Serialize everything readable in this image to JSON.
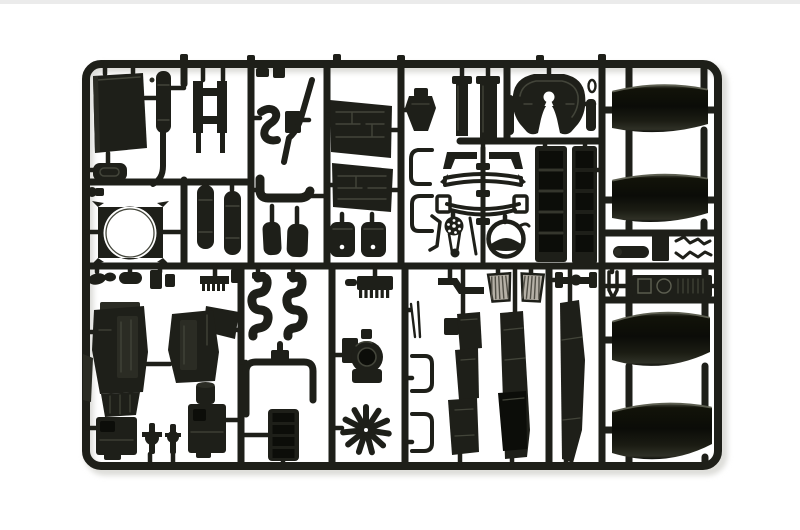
{
  "image": {
    "kind": "photograph",
    "description": "Black injection-molded plastic model kit sprue (parts tree) with truck components — fenders, engine halves, fifth-wheel coupling, fan shroud, tanks, pipes and panels — photographed on a white background",
    "background": "#ffffff"
  },
  "palette": {
    "bg": "#ffffff",
    "photo_edge": "#ebebeb",
    "shadow": "#dcdcd8",
    "plastic": "#1e1f19",
    "plastic_deep": "#0c0d09",
    "plastic_mid": "#2b2c24",
    "plastic_hi": "#43453a",
    "sheen": "#5d5f51",
    "grille_fill": "#b5b0a6",
    "grille_line": "#504e45"
  },
  "parts": [
    {
      "id": "sprue-frame",
      "label": "outer sprue frame and runners"
    },
    {
      "id": "cab-roof-panel",
      "label": "large flat cab panel"
    },
    {
      "id": "exhaust-muffler-stack",
      "label": "muffler with exhaust stack pipe"
    },
    {
      "id": "cab-step-plate",
      "label": "oval step plate"
    },
    {
      "id": "hose-clamp-small",
      "label": "small clamp"
    },
    {
      "id": "radiator-fan-shroud",
      "label": "fan shroud with round opening"
    },
    {
      "id": "chassis-cross-member",
      "label": "chassis cross member"
    },
    {
      "id": "air-tanks",
      "label": "pair of cylindrical air tanks"
    },
    {
      "id": "s-shaped-hose",
      "label": "S-shaped intake hose"
    },
    {
      "id": "junction-box",
      "label": "small junction box"
    },
    {
      "id": "exhaust-down-pipe",
      "label": "diagonal exhaust pipe"
    },
    {
      "id": "elbow-pipe",
      "label": "elbow pipe"
    },
    {
      "id": "seat-pads",
      "label": "pair of seat cushions"
    },
    {
      "id": "small-fittings-top",
      "label": "small fittings"
    },
    {
      "id": "floor-panel-upper",
      "label": "textured cab floor panel"
    },
    {
      "id": "floor-panel-lower",
      "label": "textured cab floor panel"
    },
    {
      "id": "fuel-canisters",
      "label": "pair of canisters"
    },
    {
      "id": "gear-lever-boot",
      "label": "gear lever boot"
    },
    {
      "id": "pillar-trims",
      "label": "pair of pillar trim strips"
    },
    {
      "id": "suspension-assembly",
      "label": "symmetric leaf-spring suspension cluster"
    },
    {
      "id": "spring-shackle-brackets",
      "label": "wire shackle brackets"
    },
    {
      "id": "drive-pulley-belt",
      "label": "pulley with drive belt"
    },
    {
      "id": "air-intake-ring",
      "label": "round air intake ring"
    },
    {
      "id": "angle-bracket-small",
      "label": "small angled bracket"
    },
    {
      "id": "fifth-wheel-coupling",
      "label": "fifth wheel coupling plate"
    },
    {
      "id": "coupling-pins",
      "label": "coupling pins"
    },
    {
      "id": "o-ring-small",
      "label": "small O-ring"
    },
    {
      "id": "radiator-core-left",
      "label": "slatted radiator core"
    },
    {
      "id": "radiator-core-right",
      "label": "slatted radiator core"
    },
    {
      "id": "fender-upper-front",
      "label": "glossy wheel fender"
    },
    {
      "id": "fender-upper-rear",
      "label": "glossy wheel fender"
    },
    {
      "id": "air-cylinder-small",
      "label": "small air cylinder"
    },
    {
      "id": "bracket-plate-small",
      "label": "small bracket plate"
    },
    {
      "id": "wiper-arms-pair",
      "label": "zig-zag wiper arms"
    },
    {
      "id": "fittings-row",
      "label": "row of small engine fittings"
    },
    {
      "id": "engine-block-left",
      "label": "engine block half with gearbox"
    },
    {
      "id": "engine-block-right",
      "label": "engine block half with gearbox"
    },
    {
      "id": "gear-linkage-pair",
      "label": "gear linkage parts"
    },
    {
      "id": "exhaust-manifolds",
      "label": "pair of serpentine exhaust manifolds"
    },
    {
      "id": "coolant-u-pipe",
      "label": "rectangular coolant pipe loop"
    },
    {
      "id": "intake-manifold",
      "label": "slatted intake manifold"
    },
    {
      "id": "part-number-tag",
      "label": "molded tag on frame"
    },
    {
      "id": "oil-cooler-finned",
      "label": "finned oil cooler"
    },
    {
      "id": "turbocharger",
      "label": "turbocharger housing"
    },
    {
      "id": "radial-fan",
      "label": "multi-blade radial fan"
    },
    {
      "id": "antenna-rods",
      "label": "thin rods"
    },
    {
      "id": "c-channel-brackets",
      "label": "C-channel brackets"
    },
    {
      "id": "step-bracket-angled",
      "label": "angled step bracket"
    },
    {
      "id": "cab-step-grilles",
      "label": "pair of ribbed light-grey step grilles"
    },
    {
      "id": "front-axle-beam",
      "label": "front axle beam"
    },
    {
      "id": "side-skirt-stepped",
      "label": "stepped chassis side skirt"
    },
    {
      "id": "side-skirt-mid",
      "label": "long chassis side skirt"
    },
    {
      "id": "side-skirt-narrow",
      "label": "narrow chassis side skirt"
    },
    {
      "id": "dashboard-panel",
      "label": "dashboard panel with instruments"
    },
    {
      "id": "hinge-clips",
      "label": "small hinge clips"
    },
    {
      "id": "fender-lower-front",
      "label": "glossy wheel fender"
    },
    {
      "id": "fender-lower-rear",
      "label": "glossy wheel fender"
    }
  ]
}
